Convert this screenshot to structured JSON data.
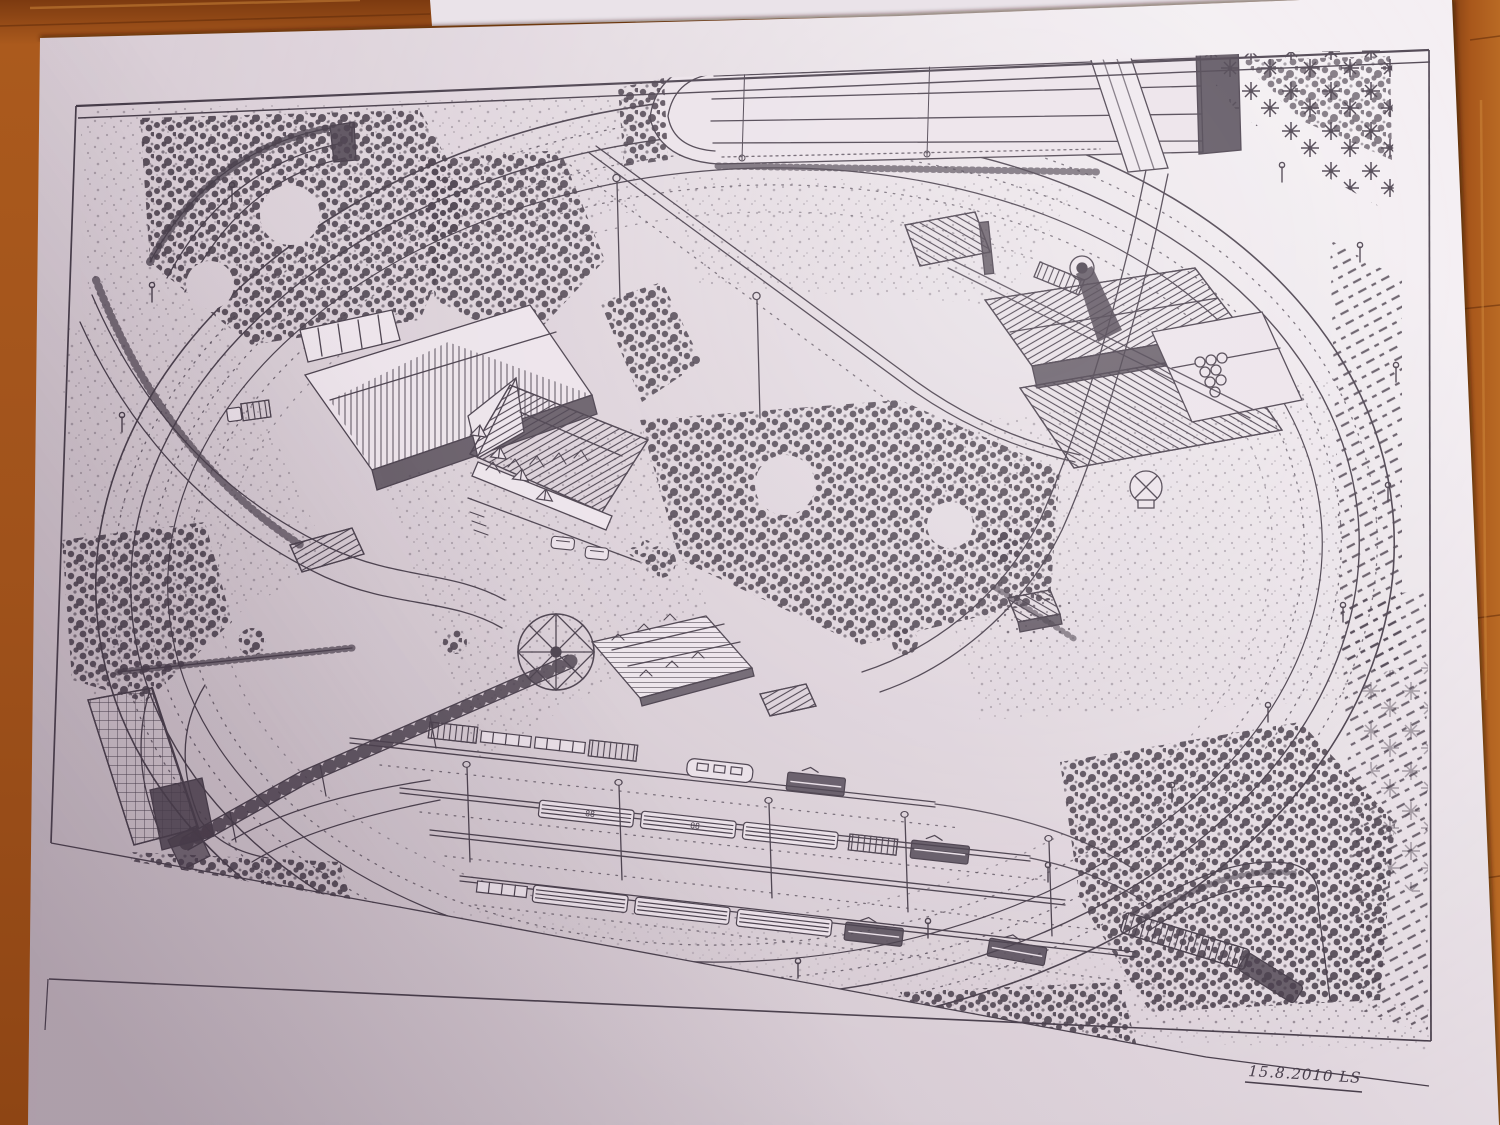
{
  "scene": {
    "type": "photograph",
    "subject": "hand-drawn pen-and-ink bird's-eye plan of a model railway layout",
    "surface": "orange-brown wooden table top with plank seams",
    "sheet": "white paper sheet, slightly rotated, second sheet peeking at top edge"
  },
  "colors": {
    "wood_base": "#a8571b",
    "wood_dark": "#6f330e",
    "wood_light": "#c8812f",
    "paper_light": "#f3eef2",
    "paper_mid": "#ded3db",
    "paper_shadow": "#c9bcc5",
    "ink": "#463c49",
    "ink_soft": "#6f6371"
  },
  "drawing": {
    "signature": "15.8.2010 LS",
    "coach_marking": "88",
    "border": "double ruled frame line around the plan",
    "features": {
      "hidden_staging_yard": "hidden staging yard with dark tunnel portal (top)",
      "level_crossing": "road level crossing beside the staging yard",
      "pine_forest": "dense conifer forest in top-right corner",
      "main_oval": "double-track electrified oval main line with catenary masts",
      "tl_tunnel": "tunnel cutting with retaining walls (top left)",
      "barn": "large farm barn with open shelter and parked truck (left)",
      "hotel": "hotel-restaurant with terrace, parked cars and market stalls",
      "station_building": "station building with dormered hip roof",
      "goods_shed": "small goods shed beside the station",
      "platforms": "station platforms with passenger and freight trains",
      "footbridge": "long covered footbridge ramp crossing the tracks",
      "greenhouse": "glass-roofed shelter at lower left",
      "bl_tunnel": "walled tunnel cutting diving under the station (bottom left)",
      "br_tunnel": "train emerging from curved walled cutting (bottom right)",
      "industry": "industrial complex with crane, pipe stack and water tower (right)",
      "hut": "lineside hut on a mound (right centre)",
      "compass_rose": "eight-pointed compass rose",
      "fields": "ploughed field rows along the right edge",
      "woods": "stippled deciduous tree masses and bushes"
    }
  }
}
